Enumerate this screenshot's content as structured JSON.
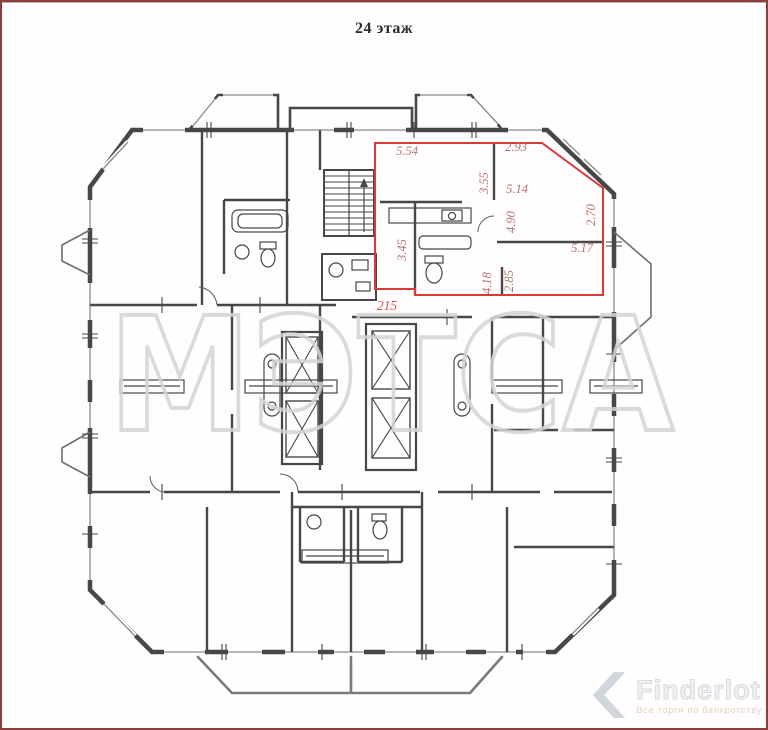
{
  "page": {
    "title": "24 этаж"
  },
  "plan": {
    "unit_number": "215",
    "dimensions": [
      "5.54",
      "2.93",
      "3.55",
      "5.14",
      "4.90",
      "2.70",
      "3.45",
      "5.17",
      "4.18",
      "2.85"
    ]
  },
  "watermark": {
    "text": "МЭТСА"
  },
  "logo": {
    "name": "Finderlot",
    "tagline": "Все торги по банкротству"
  },
  "colors": {
    "highlight_outline": "#d93a35",
    "dimension_text": "#b5716d",
    "unit_number_text": "#d85450",
    "plan_line": "#474747",
    "watermark": "#d4d4d4",
    "page_border": "#8d3f3c"
  }
}
